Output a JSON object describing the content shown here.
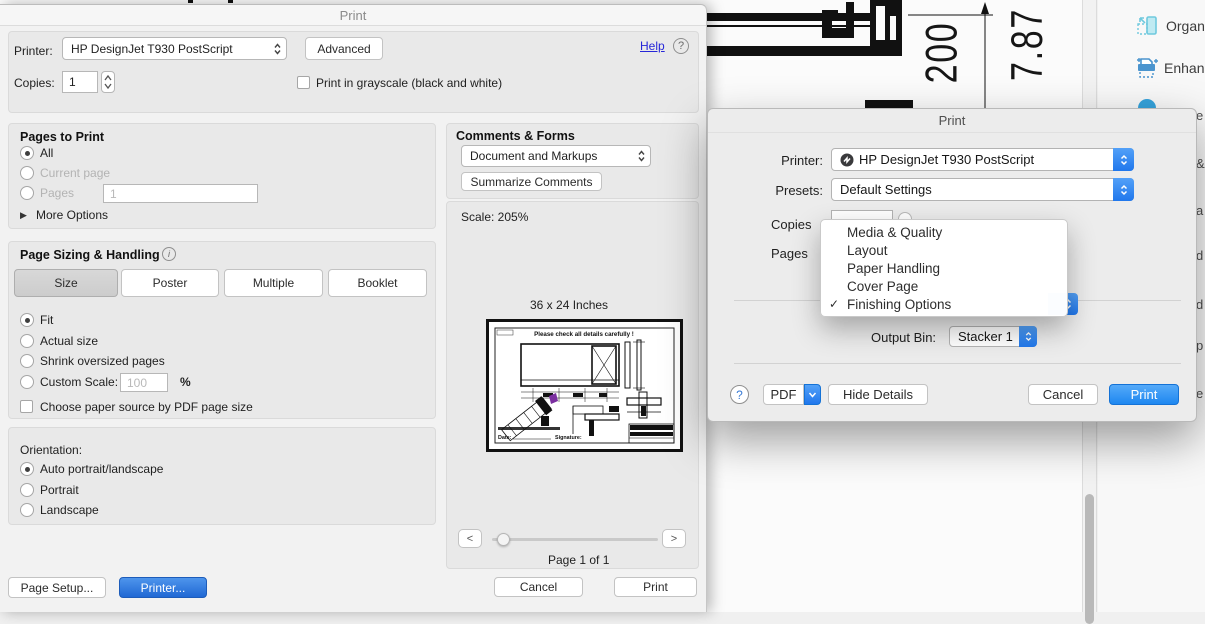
{
  "icons": {
    "question": "?",
    "check": "✓",
    "triangle_right": "▶",
    "chevron_left": "<",
    "chevron_right": ">",
    "info": "i"
  },
  "background": {
    "dim_vertical_1": "200",
    "dim_vertical_2": "7.87",
    "tools_panel_items": [
      {
        "label": "Organ"
      },
      {
        "label": "Enhan"
      }
    ],
    "edge_letters": [
      "e",
      "&",
      "a",
      "d",
      "d",
      "p",
      "e"
    ]
  },
  "acrobat_dialog": {
    "title": "Print",
    "printer_label": "Printer:",
    "printer_value": "HP DesignJet T930 PostScript",
    "advanced_button": "Advanced",
    "help_link": "Help",
    "copies_label": "Copies:",
    "copies_value": "1",
    "grayscale_label": "Print in grayscale (black and white)",
    "pages_to_print": {
      "heading": "Pages to Print",
      "all_label": "All",
      "current_page_label": "Current page",
      "pages_label": "Pages",
      "pages_value": "1",
      "more_options_label": "More Options"
    },
    "page_sizing": {
      "heading": "Page Sizing & Handling",
      "size_button": "Size",
      "poster_button": "Poster",
      "multiple_button": "Multiple",
      "booklet_button": "Booklet",
      "fit_label": "Fit",
      "actual_size_label": "Actual size",
      "shrink_label": "Shrink oversized pages",
      "custom_scale_label": "Custom Scale:",
      "custom_scale_value": "100",
      "percent_label": "%",
      "paper_source_label": "Choose paper source by PDF page size"
    },
    "orientation": {
      "heading": "Orientation:",
      "auto_label": "Auto portrait/landscape",
      "portrait_label": "Portrait",
      "landscape_label": "Landscape"
    },
    "comments_forms": {
      "heading": "Comments & Forms",
      "dropdown_value": "Document and Markups",
      "summarize_button": "Summarize Comments"
    },
    "preview": {
      "scale_text": "Scale: 205%",
      "size_text": "36 x 24 Inches",
      "page_text": "Page 1 of 1",
      "thumb_title": "Please check all details carefully !",
      "thumb_date_label": "Date:",
      "thumb_signature_label": "Signature:"
    },
    "page_setup_button": "Page Setup...",
    "printer_button": "Printer...",
    "cancel_button": "Cancel",
    "print_button": "Print"
  },
  "macos_dialog": {
    "title": "Print",
    "printer_label": "Printer:",
    "printer_value": "HP DesignJet T930 PostScript",
    "presets_label": "Presets:",
    "presets_value": "Default Settings",
    "copies_label": "Copies",
    "pages_label": "Pages",
    "menu_items": [
      {
        "label": "Media & Quality",
        "checked": false
      },
      {
        "label": "Layout",
        "checked": false
      },
      {
        "label": "Paper Handling",
        "checked": false
      },
      {
        "label": "Cover Page",
        "checked": false
      },
      {
        "label": "Finishing Options",
        "checked": true
      }
    ],
    "output_bin_label": "Output Bin:",
    "output_bin_value": "Stacker 1",
    "pdf_button": "PDF",
    "hide_details_button": "Hide Details",
    "cancel_button": "Cancel",
    "print_button": "Print"
  },
  "colors": {
    "mac_blue": "#2077ec",
    "acrobat_blue_button": "#2068d4",
    "link_blue": "#2626d8"
  }
}
